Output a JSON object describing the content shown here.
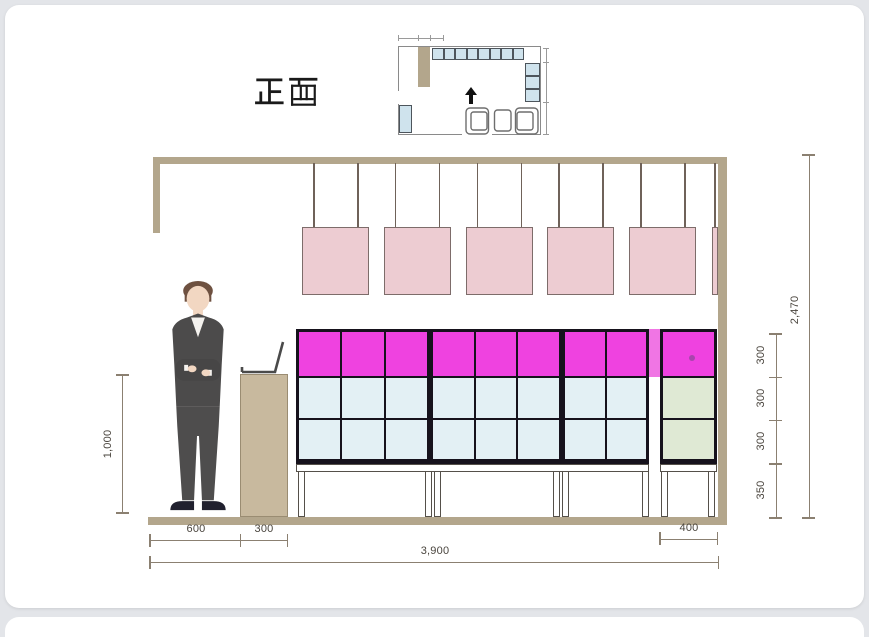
{
  "title": {
    "label": "正面"
  },
  "dimensions": {
    "podium_height": "1,000",
    "floor_person": "600",
    "floor_podium": "300",
    "floor_total": "3,900",
    "floor_right_unit": "400",
    "row_top": "300",
    "row_mid": "300",
    "row_bottom": "300",
    "base_height": "350",
    "ceiling_height": "2,470"
  },
  "furniture": {
    "pendant_count": 5,
    "main_sections": [
      3,
      3,
      2
    ],
    "main_rows": [
      "magenta",
      "blue",
      "blue"
    ],
    "right_rows": [
      "magenta",
      "green",
      "green"
    ],
    "plan_top_shelf_count": 8,
    "plan_side_shelf_count": 3
  },
  "colors": {
    "magenta": "#ef42e0",
    "magenta_light": "#f075e4",
    "magenta_dot": "#a845ad",
    "cell_blue": "#e3f0f4",
    "cell_green": "#dfe9d4",
    "pendant_pink": "#edccd2",
    "pendant_border": "#7d6c6a",
    "tan": "#b3a68c",
    "podium_tan": "#c8b99e",
    "line_gray": "#8b8071",
    "dim_text": "#4a453e",
    "cell_border": "#16121c",
    "plan_blue": "#cfe3ed",
    "plan_line": "#8a8a8a"
  }
}
